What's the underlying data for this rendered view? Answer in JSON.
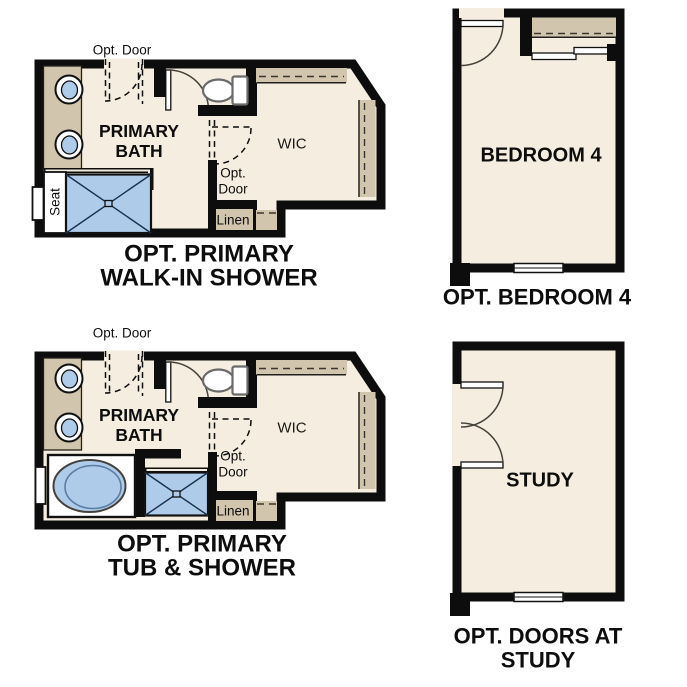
{
  "colors": {
    "background": "#ffffff",
    "wall": "#0d0d0d",
    "floor": "#f5eee0",
    "cabinet_tan": "#d2c5ad",
    "fixture_blue": "#aecbe9",
    "text": "#0d0d0d"
  },
  "plans": [
    {
      "id": "opt-primary-walk-in-shower",
      "caption": [
        "OPT. PRIMARY",
        "WALK-IN SHOWER"
      ],
      "labels": {
        "opt_door_top": "Opt. Door",
        "room": "PRIMARY BATH",
        "wic": "WIC",
        "opt_door_mid": "Opt. Door",
        "linen": "Linen",
        "seat": "Seat"
      }
    },
    {
      "id": "opt-primary-tub-and-shower",
      "caption": [
        "OPT. PRIMARY",
        "TUB & SHOWER"
      ],
      "labels": {
        "opt_door_top": "Opt. Door",
        "room": "PRIMARY BATH",
        "wic": "WIC",
        "opt_door_mid": "Opt. Door",
        "linen": "Linen"
      }
    },
    {
      "id": "opt-bedroom-4",
      "caption": [
        "OPT. BEDROOM 4"
      ],
      "labels": {
        "room": "BEDROOM 4"
      }
    },
    {
      "id": "opt-doors-at-study",
      "caption": [
        "OPT. DOORS AT",
        "STUDY"
      ],
      "labels": {
        "room": "STUDY"
      }
    }
  ]
}
